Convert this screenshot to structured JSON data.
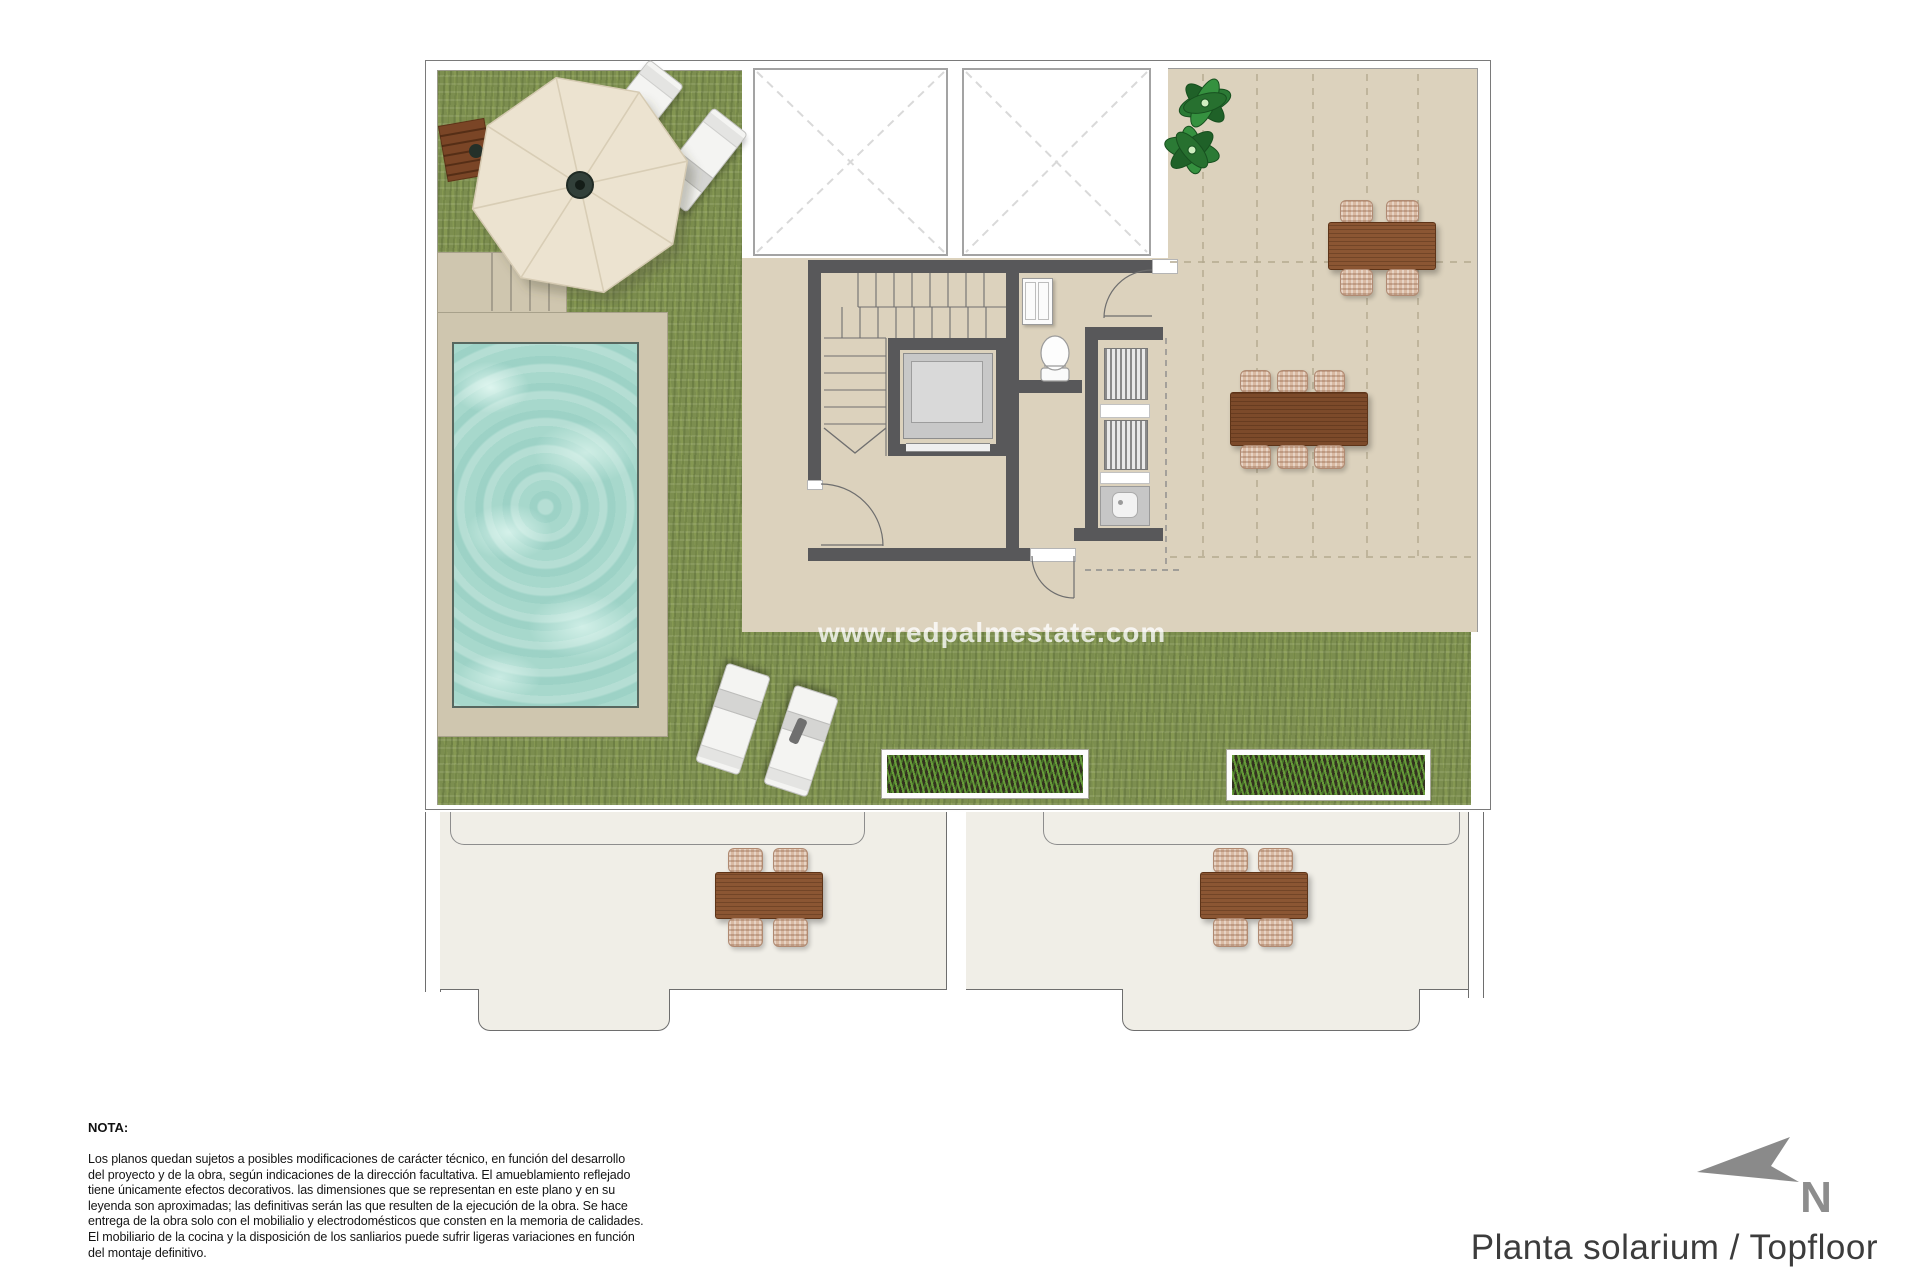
{
  "watermark": "www.redpalmestate.com",
  "footer": {
    "title": "Planta solarium / Topfloor",
    "compass_label": "N"
  },
  "note": {
    "heading": "NOTA:",
    "body": "Los planos quedan sujetos a posibles modificaciones de carácter técnico, en función del desarrollo\ndel proyecto y de la obra, según indicaciones de la dirección facultativa. El amueblamiento reflejado\ntiene únicamente efectos decorativos. las dimensiones que se representan en este plano y en su\nleyenda son aproximadas; las definitivas serán las que resulten de la ejecución de la obra. Se hace\nentrega de la obra solo con el mobilialio y electrodomésticos que consten en la memoria de calidades.\nEl mobiliario de la cocina y la disposición de los sanliarios puede sufrir ligeras variaciones en función\ndel montaje definitivo."
  },
  "features": {
    "lawn": "artificial-grass-lawn",
    "pool": "swimming-pool",
    "pool_deck": "pool-deck-with-steps",
    "umbrella": "cantilever-parasol",
    "umbrella_table": "wooden-side-table",
    "sun_loungers": "sun-loungers",
    "planters": "grass-planter-boxes",
    "skylights": "double-height-void-skylights",
    "staircase": "staircase",
    "elevator": "elevator",
    "toilet": "wc-toilet",
    "vanity": "bathroom-cabinet",
    "laundry_closet": "laundry-machine-closet",
    "sink": "utility-sink",
    "dining_table_6": "outdoor-dining-table-6-seats",
    "dining_table_4": "outdoor-dining-table-4-seats",
    "lower_terraces": "lower-floor-balconies-with-tables",
    "plant": "decorative-plant",
    "pergola": "dashed-pergola-grid",
    "compass": "north-arrow"
  },
  "colors": {
    "grass": "#7c8e4f",
    "terrace": "#dcd2bd",
    "pool_water": "#a7d8cc",
    "pool_deck": "#cfc6af",
    "wall": "#58585a",
    "wood": "#8b5633",
    "chair_wicker": "#d9b9a2",
    "umbrella_fabric": "#ece3d0",
    "lower_terrace_floor": "#f0eee7",
    "title_text": "#3c3c3c",
    "compass_gray": "#8d8d8d"
  }
}
